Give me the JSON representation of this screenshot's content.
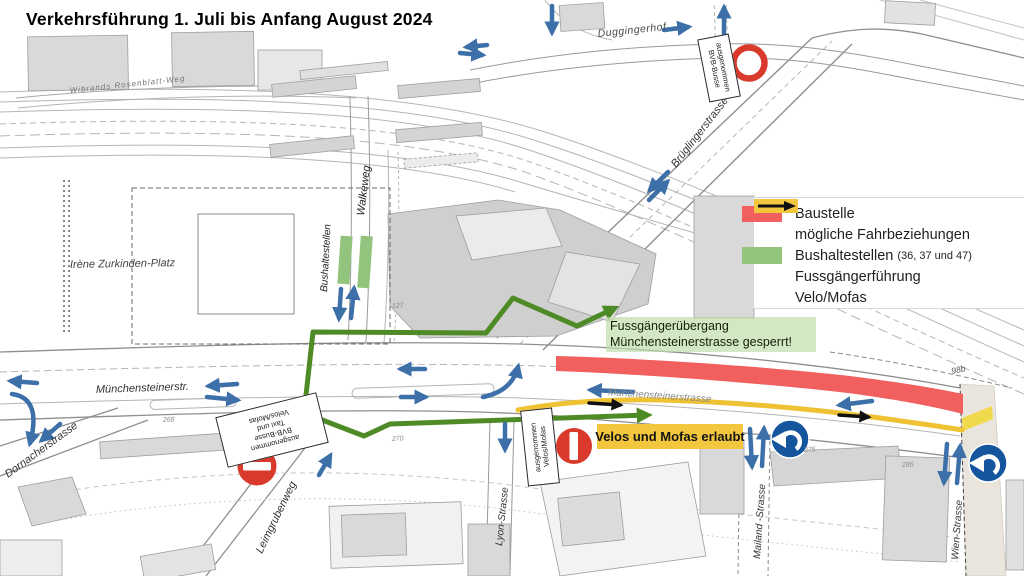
{
  "title": "Verkehrsführung 1. Juli bis Anfang August 2024",
  "legend": {
    "baustelle": "Baustelle",
    "fahrbeziehungen": "mögliche Fahrbeziehungen",
    "bushaltestellen": "Bushaltestellen",
    "bushaltestellen_lines": "(36, 37 und 47)",
    "fussgaengerfuehrung": "Fussgängerführung",
    "velo_mofas": "Velo/Mofas"
  },
  "callouts": {
    "fussgaenger_line1": "Fussgängerübergang",
    "fussgaenger_line2": "Münchensteinerstrasse gesperrt!",
    "velos_erlaubt": "Velos und Mofas erlaubt",
    "ausnahme_bus": {
      "line1": "ausgenommen",
      "line2": "BVB-Busse"
    },
    "ausnahme_bus_taxi": {
      "line1": "ausgenommen",
      "line2": "BVB-Busse",
      "line3": "Taxi und",
      "line4": "Velos/Mofas"
    },
    "ausnahme_velos": {
      "line1": "ausgenommen",
      "line2": "Velos/Mofas"
    }
  },
  "streets": {
    "wibrands": "Wibrands Rosenblatt-Weg",
    "duggingerhof": "Duggingerhof",
    "brueglingerstrasse": "Brüglingerstrasse",
    "walkeweg": "Walkeweg",
    "bushaltestellen": "Bushaltestellen",
    "zurkinden_platz": "Irène Zurkinden-Platz",
    "muenchensteinerstr": "Münchensteinerstr.",
    "muenchensteinerstrasse": "Münchensteinerstrasse",
    "dornacherstrasse": "Dornacherstrasse",
    "leimgrubenweg": "Leimgrubenweg",
    "lyon": "Lyon-Strasse",
    "mailand": "Mailand -Strasse",
    "wien": "Wien-Strasse"
  },
  "parcels": {
    "p127": "127",
    "p268": "268",
    "p270": "270",
    "p275": "275",
    "p286": "286",
    "p98b": "98b"
  },
  "colors": {
    "baustelle_red": "#f15f5f",
    "fahrbeziehung_blue": "#3d6fa8",
    "bushaltestelle_green": "#93c47d",
    "fussgaenger_green": "#4e8b26",
    "velo_yellow": "#eec233",
    "velo_band_yellow": "#f2c63d",
    "sign_red": "#d93a2b",
    "sign_blue": "#14559e"
  }
}
